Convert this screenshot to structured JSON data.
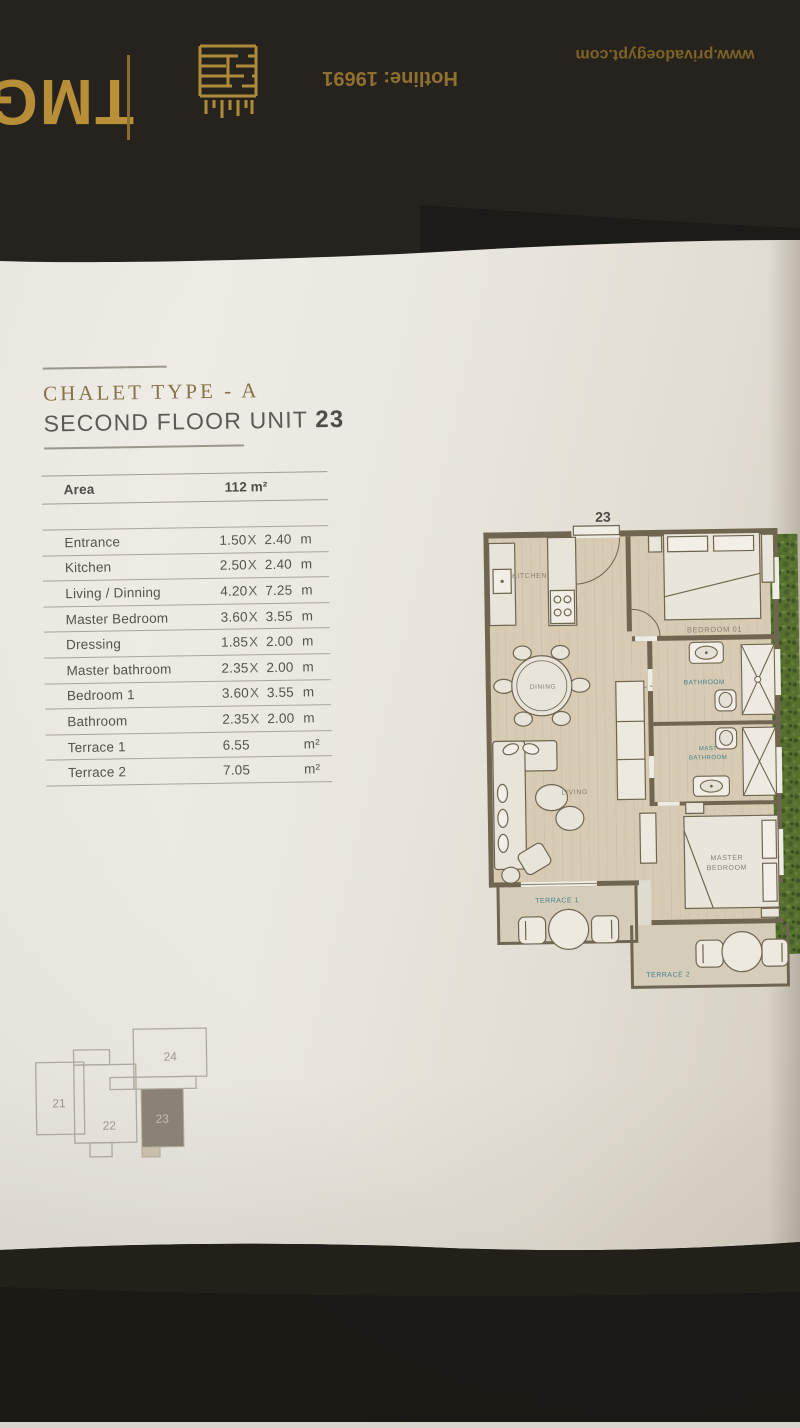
{
  "back_cover": {
    "brand": "TMG",
    "hotline": "Hotline: 19691",
    "website": "www.privadoegypt.com"
  },
  "title": {
    "line1": "CHALET TYPE - A",
    "line2_prefix": "SECOND FLOOR UNIT",
    "unit_number": "23"
  },
  "area_table": {
    "header": {
      "label": "Area",
      "value": "112",
      "unit": "m²"
    },
    "rows": [
      {
        "label": "Entrance",
        "w": "1.50",
        "sep": "X",
        "h": "2.40",
        "unit": "m"
      },
      {
        "label": "Kitchen",
        "w": "2.50",
        "sep": "X",
        "h": "2.40",
        "unit": "m"
      },
      {
        "label": "Living / Dinning",
        "w": "4.20",
        "sep": "X",
        "h": "7.25",
        "unit": "m"
      },
      {
        "label": "Master Bedroom",
        "w": "3.60",
        "sep": "X",
        "h": "3.55",
        "unit": "m"
      },
      {
        "label": "Dressing",
        "w": "1.85",
        "sep": "X",
        "h": "2.00",
        "unit": "m"
      },
      {
        "label": "Master bathroom",
        "w": "2.35",
        "sep": "X",
        "h": "2.00",
        "unit": "m"
      },
      {
        "label": "Bedroom 1",
        "w": "3.60",
        "sep": "X",
        "h": "3.55",
        "unit": "m"
      },
      {
        "label": "Bathroom",
        "w": "2.35",
        "sep": "X",
        "h": "2.00",
        "unit": "m"
      },
      {
        "label": "Terrace 1",
        "w": "6.55",
        "sep": "",
        "h": "",
        "unit": "m²"
      },
      {
        "label": "Terrace 2",
        "w": "7.05",
        "sep": "",
        "h": "",
        "unit": "m²"
      }
    ]
  },
  "floor_plan": {
    "unit_number": "23",
    "rooms": {
      "kitchen": "KITCHEN",
      "bedroom1": "BEDROOM 01",
      "dining": "DINING",
      "bathroom": "BATHROOM",
      "master_bath1": "MAST",
      "master_bath2": "BATHROOM",
      "living": "LIVING",
      "master_bed1": "MASTER",
      "master_bed2": "BEDROOM",
      "terrace1": "TERRACE 1",
      "terrace2": "TERRACE 2"
    }
  },
  "key_plan": {
    "units": [
      {
        "label": "21",
        "highlighted": false
      },
      {
        "label": "22",
        "highlighted": false
      },
      {
        "label": "23",
        "highlighted": true
      },
      {
        "label": "24",
        "highlighted": false
      }
    ]
  },
  "colors": {
    "title_gold": "#86744a",
    "cover_gold": "#bd9238",
    "cover_bg": "#26231e",
    "teal_label": "#44808d",
    "plan_wall": "#6f6550",
    "plan_floor": "#d7cbb3",
    "hedge_green": "#55702f",
    "keyplan_highlight": "#8d8477"
  }
}
